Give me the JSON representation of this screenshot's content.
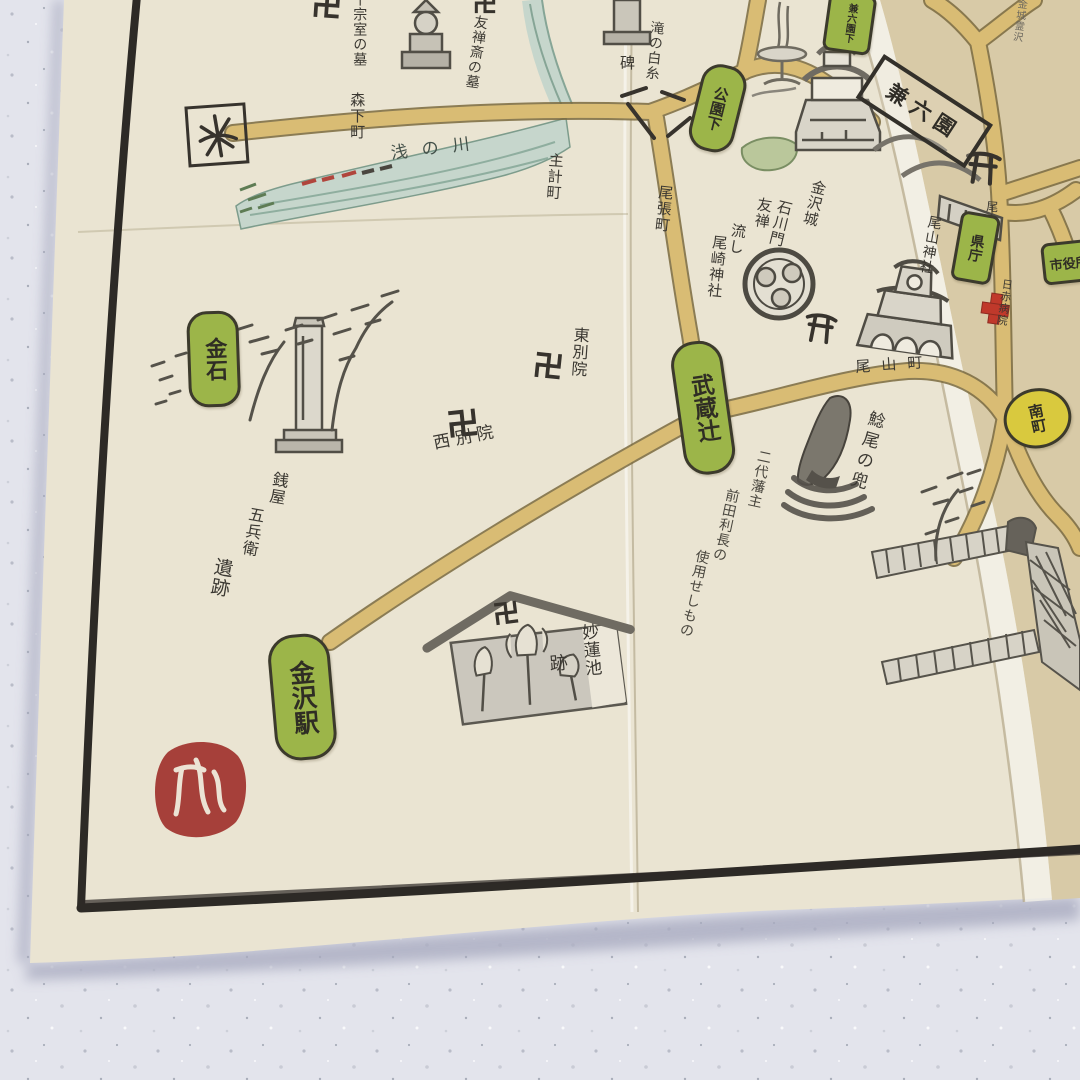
{
  "scene": {
    "description": "Photo of a folded hand-drawn illustrated tourist map of Kanazawa on cream washi paper, lying on a white marble counter",
    "colors": {
      "paper": "#eae4d2",
      "paper_right_fold": "#d8caa7",
      "marble": "#e3e4ec",
      "ink": "#3b3832",
      "road": "#d9bc74",
      "river": "#c6d6cc",
      "badge_green": "#9cb549",
      "badge_yellow": "#d9c93e",
      "seal_red": "#a6403a",
      "border_black": "#2d2a26",
      "hospital_cross_red": "#c0392b"
    }
  },
  "badges": {
    "kanaiwa": "金石",
    "kanazawa_eki": "金沢駅",
    "musashi": "武蔵辻",
    "koenshita": "公園下",
    "kencho": "県庁",
    "shiyakusho": "市役所",
    "minamicho": "南町",
    "kenrokuen_shita": "兼六園下"
  },
  "labels": {
    "sen_grave": "千宗室の墓",
    "yuzensai_grave": "友禅斎の墓",
    "morishita": "森下町",
    "asanogawa": "浅の川",
    "yuzen1": "友禅",
    "yuzen2": "流し",
    "kazuemachi": "主計町",
    "taki": "滝の白糸",
    "hi": "碑",
    "owaricho": "尾張町",
    "higashi_betsuin": "東別院",
    "nishi_betsuin": "西別院",
    "ozaki_jinja": "尾崎神社",
    "kanazawajo": "金沢城",
    "ishikawamon": "石川門",
    "oyama_jinja": "尾山神社",
    "oyamacho": "尾山町",
    "oyamadori": "尾山通り",
    "nikkeki": "日赤病院",
    "kenrokuen": "兼六園",
    "kinjo": "金城霊沢",
    "namazuo": "鯰尾の兜",
    "maeda1": "二代藩主",
    "maeda2": "前田利長の",
    "maeda3": "使用せしもの",
    "myorenchi": "妙蓮池",
    "ato": "跡",
    "zeniya1": "銭屋",
    "zeniya2": "五兵衛",
    "zeniya3": "遺跡"
  },
  "icons": {
    "manji": "swastika temple mark 卍",
    "torii": "torii shrine gate mark",
    "north_box": "boxed hand-drawn direction mark",
    "red_cross": "hospital red cross",
    "red_seal": "round red artist seal with white calligraphy",
    "bridge_ticks": "black bridge railing marks",
    "sketches": [
      "stone pagoda grave",
      "shiraito monument",
      "fountain",
      "kanazawa castle ishikawa gate",
      "aoi crest of ozaki shrine",
      "oyama shrine gate",
      "namazuo helmet",
      "zeniya gohei monument with pines",
      "lotus pond hall",
      "stone walls with pine"
    ]
  }
}
